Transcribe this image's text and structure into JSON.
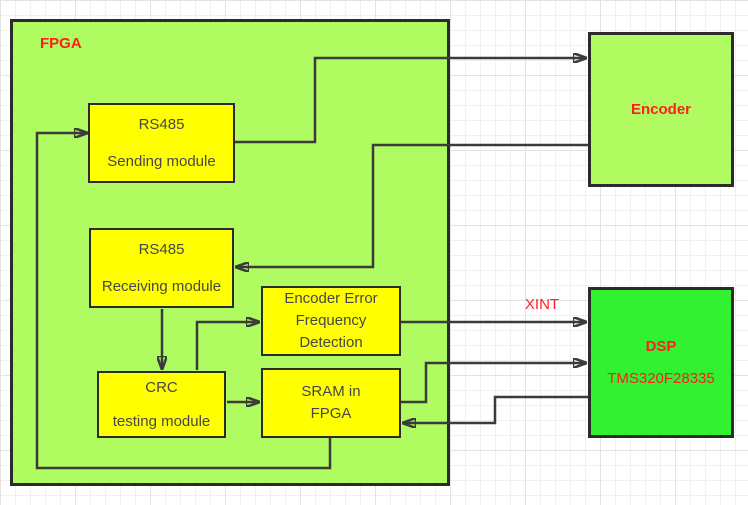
{
  "nodes": {
    "fpga": {
      "label": "FPGA"
    },
    "rs485_sending": {
      "line1": "RS485",
      "line2": "Sending module"
    },
    "rs485_receiving": {
      "line1": "RS485",
      "line2": "Receiving module"
    },
    "encoder_error_detection": {
      "line1": "Encoder Error",
      "line2": "Frequency",
      "line3": "Detection"
    },
    "crc_testing": {
      "line1": "CRC",
      "line2": "testing module"
    },
    "sram": {
      "line1": "SRAM in",
      "line2": "FPGA"
    },
    "encoder": {
      "label": "Encoder"
    },
    "dsp": {
      "label": "DSP",
      "part_number": "TMS320F28335"
    }
  },
  "signals": {
    "xint_label": "XINT"
  },
  "colors": {
    "fpga_fill": "#AFFB60",
    "encoder_fill": "#AFFB60",
    "dsp_fill": "#32F032",
    "module_fill": "#FFFF00",
    "box_border": "#2B2B2B",
    "wire": "#3B3B3B",
    "red_label": "#FF1E1E",
    "module_text": "#474747",
    "grid_minor": "#F0F0F0",
    "grid_major": "#E3E3E3"
  }
}
